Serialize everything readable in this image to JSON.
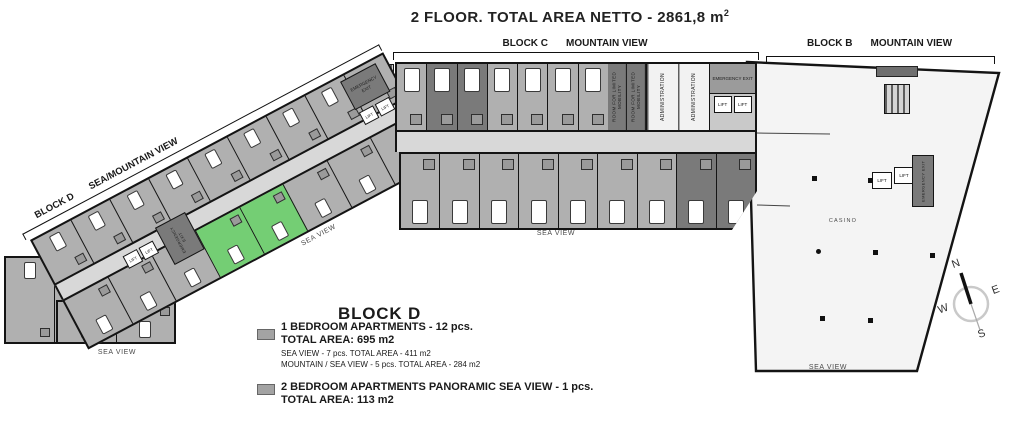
{
  "title": {
    "main": "2 FLOOR. TOTAL AREA NETTO - 2861,8 m",
    "sup": "2"
  },
  "labels": {
    "block_c_name": "BLOCK C",
    "block_c_view": "MOUNTAIN VIEW",
    "block_b_name": "BLOCK B",
    "block_b_view": "MOUNTAIN VIEW",
    "block_d_name": "BLOCK D",
    "block_d_view": "SEA/MOUNTAIN VIEW",
    "sea_view": "SEA VIEW",
    "casino": "CASINO"
  },
  "rooms": {
    "lift": "LIFT",
    "administration": "ADMINISTRATION",
    "limited_mobility": "ROOM FOR LIMITED MOBILITY",
    "emergency_exit": "EMERGENCY EXIT"
  },
  "legend": {
    "heading": "BLOCK D",
    "items": [
      {
        "label": "1 BEDROOM APARTMENTS - 12 pcs.",
        "total": "TOTAL AREA: 695 m2",
        "details": [
          "SEA VIEW - 7 pcs. TOTAL AREA - 411 m2",
          "MOUNTAIN / SEA VIEW - 5 pcs. TOTAL AREA - 284 m2"
        ]
      },
      {
        "label": "2 BEDROOM APARTMENTS PANORAMIC SEA VIEW - 1 pcs.",
        "total": "TOTAL AREA: 113 m2",
        "details": []
      }
    ]
  },
  "compass": {
    "n": "N",
    "e": "E",
    "w": "W",
    "s": "S"
  },
  "colors": {
    "apartment": "#b0b0b0",
    "dark_unit": "#7a7a7a",
    "corridor": "#d8d8d8",
    "highlight_green": "#74ce74",
    "block_b_fill": "#f4f4f4",
    "legend_swatch": "#a3a3a3"
  }
}
